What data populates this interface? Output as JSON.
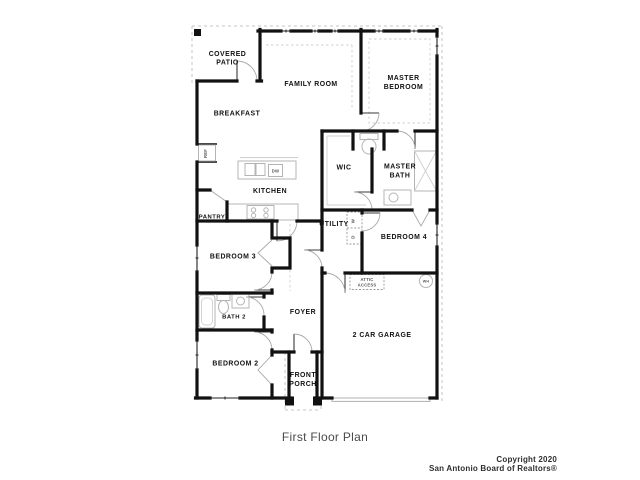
{
  "canvas": {
    "width": 640,
    "height": 480,
    "background": "#ffffff"
  },
  "plan": {
    "caption": "First Floor Plan",
    "colors": {
      "wall": "#111111",
      "window": "#222222",
      "door_arc": "#a8a8a8",
      "fixture": "#b4b4b4",
      "roof_dash": "#c6c6c6",
      "room_label": "#111111",
      "fixture_label": "#555555",
      "caption": "#4a4a4a",
      "copyright": "#2e2e2e"
    },
    "room_labels": [
      {
        "id": "covered-patio",
        "lines": [
          "COVERED",
          "PATIO"
        ],
        "x": 227.5,
        "y": 56,
        "size": 6.9,
        "lh": 8.6
      },
      {
        "id": "family-room",
        "lines": [
          "FAMILY ROOM"
        ],
        "x": 311,
        "y": 86,
        "size": 6.9
      },
      {
        "id": "master-bedroom",
        "lines": [
          "MASTER",
          "BEDROOM"
        ],
        "x": 403.5,
        "y": 80,
        "size": 6.9,
        "lh": 9
      },
      {
        "id": "breakfast",
        "lines": [
          "BREAKFAST"
        ],
        "x": 237,
        "y": 115.5,
        "size": 6.9
      },
      {
        "id": "kitchen",
        "lines": [
          "KITCHEN"
        ],
        "x": 270,
        "y": 193,
        "size": 6.9
      },
      {
        "id": "pantry",
        "lines": [
          "PANTRY"
        ],
        "x": 212,
        "y": 218.5,
        "size": 5.9
      },
      {
        "id": "wic",
        "lines": [
          "WIC"
        ],
        "x": 344,
        "y": 169.5,
        "size": 6.9
      },
      {
        "id": "master-bath",
        "lines": [
          "MASTER",
          "BATH"
        ],
        "x": 400,
        "y": 168.5,
        "size": 6.9,
        "lh": 9
      },
      {
        "id": "utility",
        "lines": [
          "UTILITY"
        ],
        "x": 334,
        "y": 226,
        "size": 6.9
      },
      {
        "id": "bedroom-4",
        "lines": [
          "BEDROOM 4"
        ],
        "x": 404,
        "y": 239,
        "size": 6.9
      },
      {
        "id": "bedroom-3",
        "lines": [
          "BEDROOM 3"
        ],
        "x": 233,
        "y": 258.5,
        "size": 6.9
      },
      {
        "id": "bath-2",
        "lines": [
          "BATH 2"
        ],
        "x": 234,
        "y": 318.5,
        "size": 5.9
      },
      {
        "id": "foyer",
        "lines": [
          "FOYER"
        ],
        "x": 303,
        "y": 314,
        "size": 6.9
      },
      {
        "id": "garage",
        "lines": [
          "2 CAR GARAGE"
        ],
        "x": 382,
        "y": 337,
        "size": 6.9
      },
      {
        "id": "bedroom-2",
        "lines": [
          "BEDROOM 2"
        ],
        "x": 235.5,
        "y": 365.5,
        "size": 6.9
      },
      {
        "id": "front-porch",
        "lines": [
          "FRONT",
          "PORCH"
        ],
        "x": 303,
        "y": 377,
        "size": 6.9,
        "lh": 9
      }
    ],
    "fixture_labels": [
      {
        "id": "attic-access",
        "lines": [
          "ATTIC",
          "ACCESS"
        ],
        "x": 367,
        "y": 281,
        "size": 4.2,
        "lh": 5.4
      },
      {
        "id": "ref",
        "lines": [
          "REF"
        ],
        "x": 207,
        "y": 153.5,
        "size": 4.2,
        "rotate": -90
      },
      {
        "id": "dw",
        "lines": [
          "DW"
        ],
        "x": 275.5,
        "y": 172.5,
        "size": 4.2
      },
      {
        "id": "washer",
        "lines": [
          "W"
        ],
        "x": 354.5,
        "y": 221,
        "size": 4.4,
        "rotate": -90
      },
      {
        "id": "dryer",
        "lines": [
          "D"
        ],
        "x": 354.5,
        "y": 237,
        "size": 4.4,
        "rotate": -90
      },
      {
        "id": "water-heater",
        "lines": [
          "WH"
        ],
        "x": 426,
        "y": 282.6,
        "size": 3.6
      }
    ]
  },
  "footer": {
    "copyright_lines": [
      "Copyright 2020",
      "San Antonio Board of Realtors®"
    ]
  }
}
